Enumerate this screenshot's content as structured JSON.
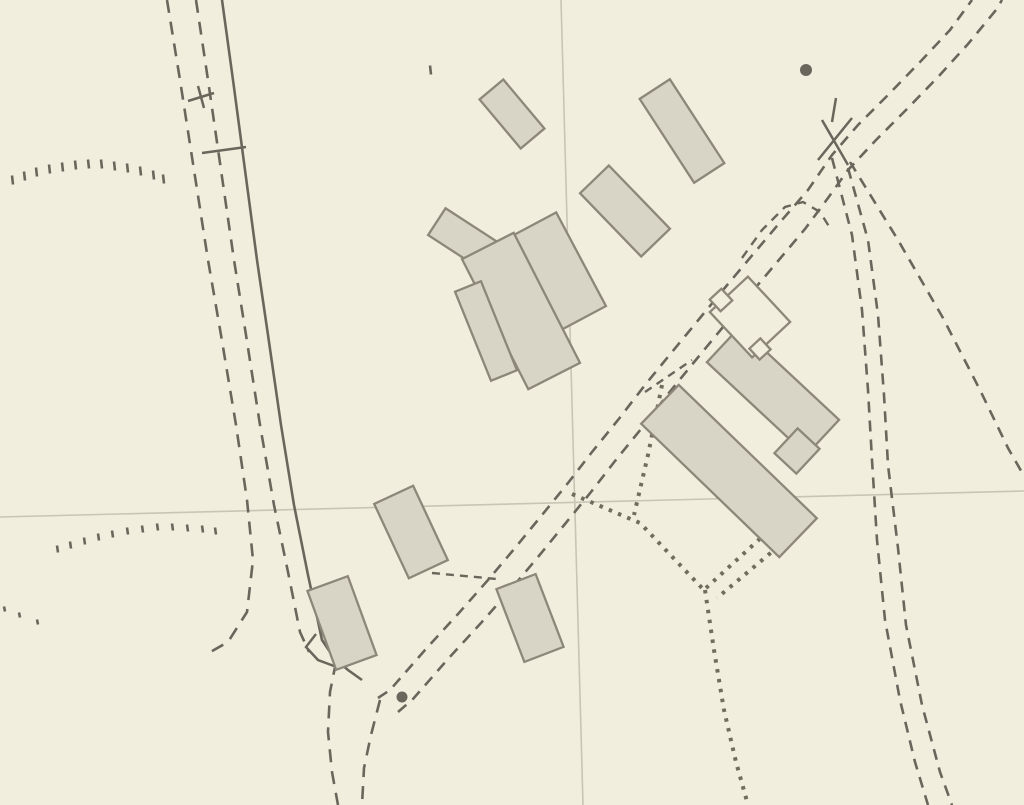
{
  "map": {
    "colors": {
      "bg": "#f2eede",
      "ink": "#6b665c",
      "grid": "#c9c5b5",
      "dotted": "#716c5e",
      "building_fill": "#d8d5c6",
      "building_stroke": "#8d8779",
      "label_navy": "#16356e",
      "map_text": "#5a544b",
      "marker_red": "#e01c1c",
      "marker_fill": "#ffffff"
    },
    "marker": {
      "label": "1",
      "x": 380,
      "y": 383,
      "w": 57,
      "h": 68
    },
    "map_texts": [
      {
        "name": "text-mile-ms",
        "t": "M S",
        "x": 800,
        "y": 12,
        "size": 25,
        "spacing": 4
      },
      {
        "name": "text-plymouth-12",
        "t": "Plymouth 12",
        "x": 800,
        "y": 46,
        "size": 30,
        "spacing": 1
      },
      {
        "name": "text-spot-height-671",
        "t": "671",
        "x": 268,
        "y": 113,
        "size": 27,
        "spacing": 2
      },
      {
        "name": "text-benchmark",
        "t": "B M 664·62",
        "x": 206,
        "y": 676,
        "size": 26,
        "spacing": 1
      },
      {
        "name": "text-fs",
        "t": "F S",
        "x": 448,
        "y": 708,
        "size": 25,
        "spacing": 5
      }
    ],
    "building_labels": [
      {
        "t": "1",
        "x": 345,
        "y": 632
      },
      {
        "t": "2",
        "x": 416,
        "y": 550
      },
      {
        "t": "3",
        "x": 532,
        "y": 632
      },
      {
        "t": "4",
        "x": 741,
        "y": 492
      },
      {
        "t": "5",
        "x": 771,
        "y": 421
      },
      {
        "t": "6a",
        "x": 494,
        "y": 330
      },
      {
        "t": "6b",
        "x": 546,
        "y": 332
      },
      {
        "t": "6c",
        "x": 569,
        "y": 291
      },
      {
        "t": "7",
        "x": 464,
        "y": 239
      },
      {
        "t": "8",
        "x": 515,
        "y": 130
      },
      {
        "t": "9",
        "x": 629,
        "y": 224
      },
      {
        "t": "10",
        "x": 678,
        "y": 142
      }
    ],
    "buildings": [
      {
        "name": "building-8",
        "cx": 512,
        "cy": 114,
        "w": 31,
        "h": 64,
        "rot": -40
      },
      {
        "name": "building-10",
        "cx": 682,
        "cy": 131,
        "w": 36,
        "h": 100,
        "rot": -33
      },
      {
        "name": "building-9",
        "cx": 625,
        "cy": 211,
        "w": 40,
        "h": 88,
        "rot": -44
      },
      {
        "name": "building-7",
        "cx": 462,
        "cy": 238,
        "w": 60,
        "h": 32,
        "rot": 33
      },
      {
        "name": "building-6c",
        "cx": 559,
        "cy": 271,
        "w": 50,
        "h": 106,
        "rot": -28
      },
      {
        "name": "building-6b",
        "cx": 521,
        "cy": 311,
        "w": 58,
        "h": 146,
        "rot": -27
      },
      {
        "name": "building-6a",
        "cx": 486,
        "cy": 331,
        "w": 28,
        "h": 96,
        "rot": -22
      },
      {
        "name": "building-4",
        "cx": 729,
        "cy": 471,
        "w": 54,
        "h": 192,
        "rot": -46
      },
      {
        "name": "building-5",
        "cx": 773,
        "cy": 391,
        "w": 48,
        "h": 136,
        "rot": -47
      },
      {
        "name": "building-5-annex",
        "cx": 797,
        "cy": 451,
        "w": 34,
        "h": 30,
        "rot": -47
      },
      {
        "name": "building-open-yard",
        "cx": 750,
        "cy": 317,
        "w": 52,
        "h": 62,
        "rot": -43,
        "open": true
      },
      {
        "name": "building-open-yard-wing-a",
        "cx": 721,
        "cy": 300,
        "w": 16,
        "h": 16,
        "rot": -43,
        "open": true
      },
      {
        "name": "building-open-yard-wing-b",
        "cx": 760,
        "cy": 349,
        "w": 15,
        "h": 15,
        "rot": -43,
        "open": true
      },
      {
        "name": "building-2",
        "cx": 411,
        "cy": 532,
        "w": 43,
        "h": 82,
        "rot": -25
      },
      {
        "name": "building-1",
        "cx": 342,
        "cy": 623,
        "w": 43,
        "h": 84,
        "rot": -20
      },
      {
        "name": "building-3",
        "cx": 530,
        "cy": 618,
        "w": 42,
        "h": 78,
        "rot": -21
      }
    ],
    "grid_lines": [
      {
        "name": "grid-line-horizontal",
        "pts": [
          [
            0,
            517
          ],
          [
            1024,
            491
          ]
        ]
      },
      {
        "name": "grid-line-vertical",
        "pts": [
          [
            561,
            0
          ],
          [
            583,
            805
          ]
        ]
      }
    ],
    "paths": [
      {
        "name": "road-east-edge-solid",
        "w": 2.6,
        "pts": [
          [
            222,
            0
          ],
          [
            233,
            80
          ],
          [
            245,
            170
          ],
          [
            257,
            260
          ],
          [
            268,
            335
          ],
          [
            281,
            425
          ],
          [
            294,
            505
          ],
          [
            308,
            575
          ],
          [
            322,
            640
          ],
          [
            334,
            658
          ],
          [
            348,
            670
          ],
          [
            362,
            680
          ]
        ]
      },
      {
        "name": "road-dashed-middle",
        "dash": "13 9",
        "w": 2.6,
        "pts": [
          [
            196,
            0
          ],
          [
            208,
            80
          ],
          [
            221,
            170
          ],
          [
            234,
            260
          ],
          [
            246,
            335
          ],
          [
            260,
            425
          ],
          [
            274,
            505
          ],
          [
            288,
            572
          ],
          [
            300,
            632
          ],
          [
            309,
            652
          ]
        ]
      },
      {
        "name": "road-dashed-west",
        "dash": "13 9",
        "w": 2.6,
        "pts": [
          [
            167,
            0
          ],
          [
            180,
            80
          ],
          [
            194,
            170
          ],
          [
            208,
            260
          ],
          [
            221,
            335
          ],
          [
            236,
            425
          ],
          [
            247,
            500
          ],
          [
            253,
            560
          ],
          [
            247,
            612
          ],
          [
            228,
            642
          ],
          [
            205,
            655
          ]
        ]
      },
      {
        "name": "road-south-dashed-west",
        "dash": "13 9",
        "w": 2.6,
        "pts": [
          [
            336,
            662
          ],
          [
            330,
            692
          ],
          [
            328,
            732
          ],
          [
            332,
            772
          ],
          [
            338,
            805
          ]
        ]
      },
      {
        "name": "road-south-dashed-east",
        "dash": "13 9",
        "w": 2.6,
        "pts": [
          [
            380,
            700
          ],
          [
            371,
            735
          ],
          [
            364,
            768
          ],
          [
            362,
            805
          ]
        ]
      },
      {
        "name": "farm-track-northwest-edge",
        "dash": "11 8",
        "w": 2.6,
        "pts": [
          [
            378,
            698
          ],
          [
            390,
            690
          ],
          [
            425,
            650
          ],
          [
            458,
            614
          ],
          [
            488,
            580
          ],
          [
            515,
            548
          ],
          [
            542,
            515
          ],
          [
            568,
            483
          ],
          [
            592,
            452
          ],
          [
            618,
            420
          ],
          [
            645,
            385
          ],
          [
            672,
            352
          ],
          [
            700,
            318
          ],
          [
            728,
            284
          ],
          [
            755,
            252
          ],
          [
            782,
            220
          ],
          [
            808,
            190
          ],
          [
            832,
            155
          ],
          [
            858,
            125
          ],
          [
            888,
            95
          ],
          [
            920,
            62
          ],
          [
            950,
            30
          ],
          [
            972,
            0
          ]
        ]
      },
      {
        "name": "farm-track-southeast-edge",
        "dash": "11 8",
        "w": 2.6,
        "pts": [
          [
            398,
            712
          ],
          [
            413,
            699
          ],
          [
            448,
            659
          ],
          [
            481,
            623
          ],
          [
            511,
            589
          ],
          [
            538,
            557
          ],
          [
            565,
            524
          ],
          [
            591,
            492
          ],
          [
            615,
            461
          ],
          [
            641,
            429
          ],
          [
            668,
            394
          ],
          [
            695,
            361
          ],
          [
            723,
            327
          ],
          [
            751,
            293
          ],
          [
            778,
            261
          ],
          [
            805,
            229
          ],
          [
            828,
            198
          ],
          [
            848,
            170
          ],
          [
            876,
            140
          ],
          [
            906,
            110
          ],
          [
            938,
            77
          ],
          [
            968,
            44
          ],
          [
            996,
            10
          ],
          [
            1002,
            0
          ]
        ]
      },
      {
        "name": "track-south-west-edge",
        "dash": "11 8",
        "w": 2.6,
        "pts": [
          [
            832,
            158
          ],
          [
            852,
            235
          ],
          [
            862,
            310
          ],
          [
            868,
            390
          ],
          [
            872,
            460
          ],
          [
            877,
            540
          ],
          [
            885,
            620
          ],
          [
            900,
            700
          ],
          [
            915,
            762
          ],
          [
            928,
            805
          ]
        ]
      },
      {
        "name": "track-south-east-edge",
        "dash": "11 8",
        "w": 2.6,
        "pts": [
          [
            848,
            168
          ],
          [
            868,
            240
          ],
          [
            878,
            315
          ],
          [
            884,
            395
          ],
          [
            888,
            465
          ],
          [
            898,
            548
          ],
          [
            906,
            625
          ],
          [
            922,
            705
          ],
          [
            940,
            772
          ],
          [
            952,
            805
          ]
        ]
      },
      {
        "name": "boundary-southeast-dashed",
        "dash": "11 8",
        "w": 2.6,
        "pts": [
          [
            850,
            162
          ],
          [
            898,
            240
          ],
          [
            943,
            318
          ],
          [
            980,
            390
          ],
          [
            1008,
            448
          ],
          [
            1024,
            476
          ]
        ]
      },
      {
        "name": "enclosure-arc-dashed",
        "dash": "9 7",
        "w": 2.4,
        "pts": [
          [
            742,
            258
          ],
          [
            762,
            230
          ],
          [
            785,
            207
          ],
          [
            803,
            202
          ],
          [
            820,
            212
          ],
          [
            830,
            228
          ]
        ]
      },
      {
        "name": "fence-between-2-and-3",
        "dash": "8 6",
        "w": 2.4,
        "pts": [
          [
            432,
            573
          ],
          [
            497,
            579
          ]
        ]
      },
      {
        "name": "fence-near-open-yard",
        "dash": "8 6",
        "w": 2.4,
        "pts": [
          [
            645,
            392
          ],
          [
            692,
            360
          ]
        ]
      }
    ],
    "dotted_lines": [
      {
        "name": "yard-fence-a",
        "pts": [
          [
            572,
            494
          ],
          [
            640,
            523
          ],
          [
            702,
            588
          ]
        ]
      },
      {
        "name": "yard-fence-b",
        "pts": [
          [
            662,
            385
          ],
          [
            648,
            455
          ],
          [
            634,
            515
          ]
        ]
      },
      {
        "name": "yard-fence-c",
        "pts": [
          [
            775,
            525
          ],
          [
            706,
            588
          ]
        ]
      },
      {
        "name": "yard-fence-d",
        "pts": [
          [
            786,
            540
          ],
          [
            717,
            598
          ]
        ]
      },
      {
        "name": "yard-fence-south",
        "pts": [
          [
            705,
            590
          ],
          [
            714,
            650
          ],
          [
            724,
            710
          ],
          [
            736,
            762
          ],
          [
            748,
            805
          ]
        ]
      }
    ],
    "ticks": [
      {
        "name": "road-cross-tick-a",
        "pts": [
          [
            188,
            101
          ],
          [
            214,
            93
          ]
        ]
      },
      {
        "name": "road-cross-tick-b",
        "pts": [
          [
            198,
            86
          ],
          [
            204,
            108
          ]
        ]
      },
      {
        "name": "road-gate-tick",
        "pts": [
          [
            202,
            153
          ],
          [
            246,
            147
          ]
        ]
      },
      {
        "name": "track-crossing-tick-a",
        "pts": [
          [
            822,
            120
          ],
          [
            848,
            165
          ]
        ]
      },
      {
        "name": "track-crossing-tick-b",
        "pts": [
          [
            852,
            118
          ],
          [
            818,
            160
          ]
        ]
      },
      {
        "name": "track-crossing-tick-c",
        "pts": [
          [
            836,
            98
          ],
          [
            832,
            122
          ]
        ]
      },
      {
        "name": "road-bend-hook",
        "pts": [
          [
            316,
            634
          ],
          [
            306,
            647
          ],
          [
            318,
            660
          ],
          [
            334,
            666
          ]
        ]
      }
    ],
    "dots": [
      {
        "name": "milestone-dot",
        "x": 806,
        "y": 70,
        "r": 6
      },
      {
        "name": "flagstaff-dot",
        "x": 402,
        "y": 697,
        "r": 5.5
      }
    ],
    "veg_rows": [
      {
        "name": "rough-pasture-row-topleft",
        "len": 9,
        "pts": [
          [
            12,
            180
          ],
          [
            24,
            176
          ],
          [
            36,
            172
          ],
          [
            49,
            169
          ],
          [
            62,
            167
          ],
          [
            75,
            165
          ],
          [
            88,
            164
          ],
          [
            101,
            164
          ],
          [
            114,
            166
          ],
          [
            127,
            168
          ],
          [
            140,
            171
          ],
          [
            153,
            175
          ],
          [
            163,
            179
          ]
        ]
      },
      {
        "name": "rough-pasture-row-midleft",
        "len": 7,
        "pts": [
          [
            57,
            549
          ],
          [
            70,
            545
          ],
          [
            84,
            541
          ],
          [
            98,
            537
          ],
          [
            112,
            534
          ],
          [
            127,
            531
          ],
          [
            142,
            529
          ],
          [
            157,
            527
          ],
          [
            172,
            527
          ],
          [
            187,
            528
          ],
          [
            202,
            529
          ],
          [
            215,
            531
          ]
        ]
      },
      {
        "name": "rough-pasture-row-lowleft",
        "len": 5,
        "pts": [
          [
            4,
            609
          ],
          [
            19,
            615
          ],
          [
            37,
            622
          ]
        ]
      },
      {
        "name": "contour-tick-topcenter",
        "len": 9,
        "pts": [
          [
            430,
            70
          ]
        ]
      }
    ]
  }
}
